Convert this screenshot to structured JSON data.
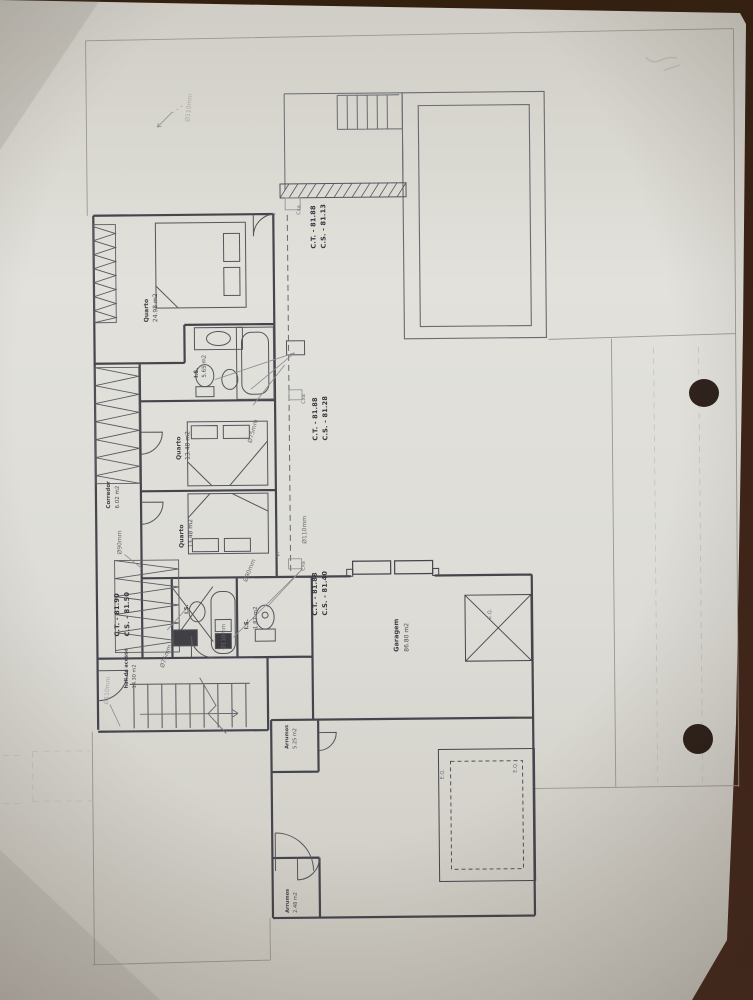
{
  "photo": {
    "paper_color": "#dfded8",
    "edge_color": "#35200f",
    "ink_color": "#45454d"
  },
  "rooms": [
    {
      "name": "Quarto",
      "area": "24.98 m2"
    },
    {
      "name": "I.S.",
      "area": "5.65 m2"
    },
    {
      "name": "Quarto",
      "area": "13.48 m2"
    },
    {
      "name": "Corredor",
      "area": "6.02 m2"
    },
    {
      "name": "Quarto",
      "area": "13.48 m2"
    },
    {
      "name": "I.S.",
      "area": "1.87 m2"
    },
    {
      "name": "I.S.",
      "area": ""
    },
    {
      "name": "hall de acesso",
      "area": "14.30 m2"
    },
    {
      "name": "Garagem",
      "area": "86.80 m2"
    },
    {
      "name": "Arrumos",
      "area": "5.25 m2"
    },
    {
      "name": "Arrumos",
      "area": "2.48 m2"
    }
  ],
  "levels": [
    {
      "ct": "C.T. - 81.88",
      "cs": "C.S. - 81.13"
    },
    {
      "ct": "C.T. - 81.88",
      "cs": "C.S. - 81.28"
    },
    {
      "ct": "C.T. - 81.88",
      "cs": "C.S. - 81.40"
    },
    {
      "ct": "C.T. - 81.90",
      "cs": "C.S. - 81.50"
    }
  ],
  "pipes": {
    "d110": "Ø110mm",
    "d90": "Ø90mm",
    "d75": "Ø75mm"
  },
  "annotations": {
    "cxa": "Cxa",
    "vr": "Vr",
    "eq": "E.Q."
  }
}
